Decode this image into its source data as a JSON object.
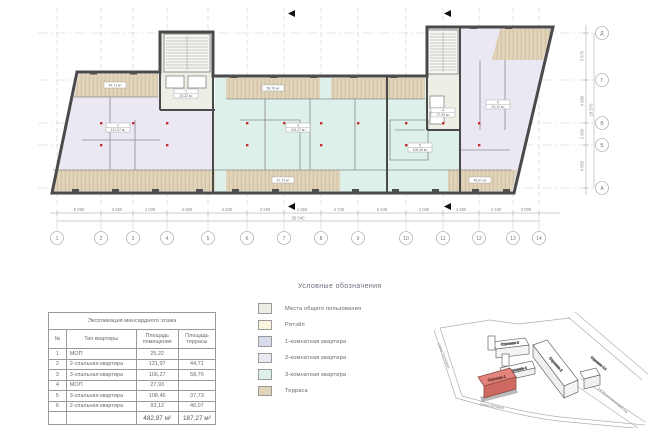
{
  "plan": {
    "grid": {
      "cols": [
        "1",
        "2",
        "3",
        "4",
        "5",
        "6",
        "7",
        "8",
        "9",
        "10",
        "11",
        "12",
        "13",
        "14"
      ],
      "col_dims": [
        "5 060",
        "3 550",
        "4 030",
        "4 850",
        "4 530",
        "4 250",
        "4 350",
        "4 740",
        "5 340",
        "4 060",
        "4 300",
        "4 100",
        "3 000"
      ],
      "col_total": "56 040",
      "rows": [
        "Д",
        "Г",
        "В",
        "Б",
        "А"
      ],
      "row_dims": [
        "5 670",
        "4 880",
        "2 900",
        "4 855"
      ],
      "row_total": "18 370"
    },
    "rooms": [
      {
        "num": "1",
        "area": "25,22 м²"
      },
      {
        "num": "2",
        "area": "121,97 м²"
      },
      {
        "num": "3",
        "area": "106,27 м²"
      },
      {
        "num": "4",
        "area": "27,93 м²"
      },
      {
        "num": "5",
        "area": "108,46 м²"
      },
      {
        "num": "6",
        "area": "93,12 м²"
      }
    ],
    "terrace_labels": [
      "44,71 м²",
      "58,76 м²",
      "37,73 м²",
      "46,07 м²"
    ]
  },
  "table": {
    "title": "Экспликация мансардного этажа",
    "headers": [
      "№",
      "Тип квартиры",
      "Площадь помещения",
      "Площадь террасы"
    ],
    "rows": [
      {
        "num": "1",
        "type": "МОП",
        "room": "25,22",
        "terrace": ""
      },
      {
        "num": "2",
        "type": "2-спальная квартира",
        "room": "121,97",
        "terrace": "44,71"
      },
      {
        "num": "3",
        "type": "3-спальная квартира",
        "room": "106,27",
        "terrace": "58,76"
      },
      {
        "num": "4",
        "type": "МОП",
        "room": "27,93",
        "terrace": ""
      },
      {
        "num": "5",
        "type": "3-спальная квартира",
        "room": "108,46",
        "terrace": "37,73"
      },
      {
        "num": "6",
        "type": "2-спальная квартира",
        "room": "93,12",
        "terrace": "46,07"
      }
    ],
    "total_room": "482,97 м²",
    "total_terrace": "187,27 м²"
  },
  "legend": {
    "title": "Условные обозначения",
    "items": [
      {
        "label": "Места общего пользования",
        "color": "#ebede3"
      },
      {
        "label": "Ритэйл",
        "color": "#fcf5dd"
      },
      {
        "label": "1-комнатная квартира",
        "color": "#d6dcee"
      },
      {
        "label": "2-комнатная квартира",
        "color": "#ebe8f4"
      },
      {
        "label": "3-комнатная квартира",
        "color": "#def0ea"
      },
      {
        "label": "Терраса",
        "color": "#e1d4ba"
      }
    ]
  },
  "map": {
    "buildings": [
      {
        "label": "Строение 1",
        "highlighted": true
      },
      {
        "label": "Строение 2",
        "highlighted": false
      },
      {
        "label": "Строение 3",
        "highlighted": false
      },
      {
        "label": "Строение 4",
        "highlighted": false
      },
      {
        "label": "Строение 4.1",
        "highlighted": false
      }
    ],
    "streets": [
      "улица Пятницкая",
      "улица Валовая",
      "3-й Монетчиковский пер"
    ],
    "highlight_color": "#e2837d"
  }
}
